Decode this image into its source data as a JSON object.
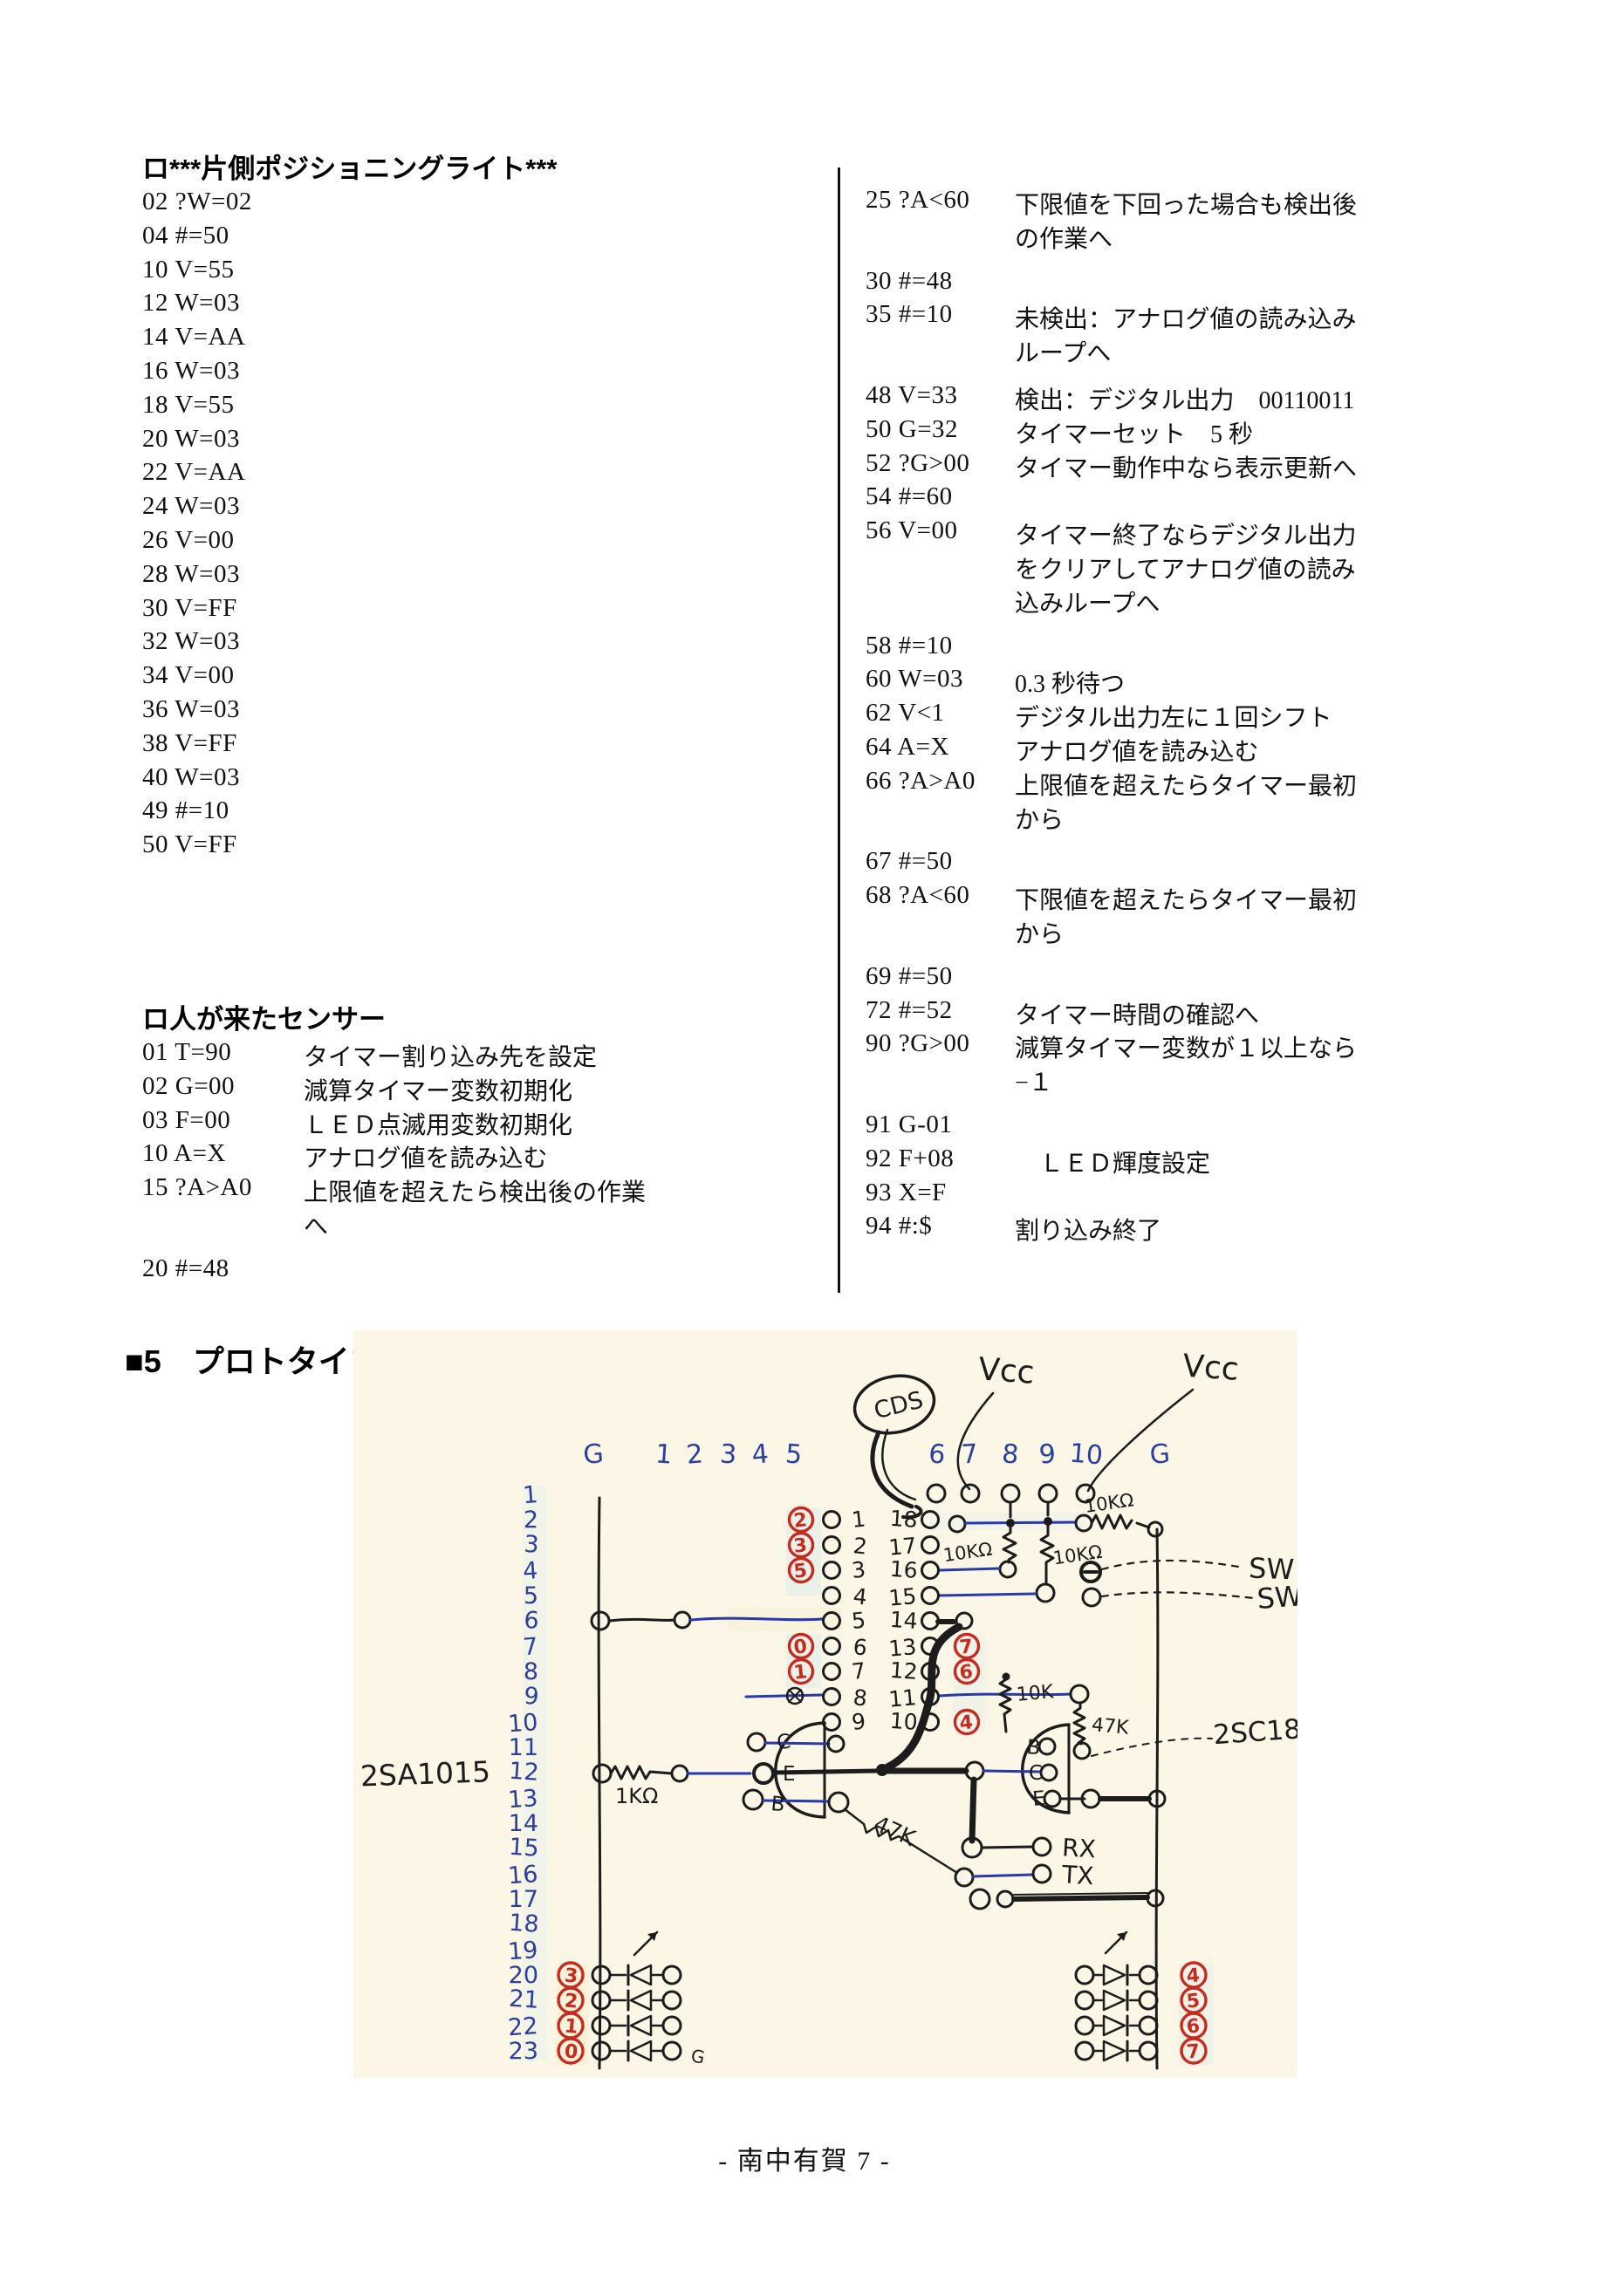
{
  "page": {
    "footer": "- 南中有賀 7 -"
  },
  "columns": {
    "left": {
      "section1": {
        "heading": "ロ***片側ポジショニングライト***",
        "lines": [
          "02 ?W=02",
          "04 #=50",
          "10 V=55",
          "12 W=03",
          "14 V=AA",
          "16 W=03",
          "18 V=55",
          "20 W=03",
          "22 V=AA",
          "24 W=03",
          "26 V=00",
          "28 W=03",
          "30 V=FF",
          "32 W=03",
          "34 V=00",
          "36 W=03",
          "38 V=FF",
          "40 W=03",
          "49 #=10",
          "50 V=FF"
        ]
      },
      "section2": {
        "heading": "ロ人が来たセンサー",
        "lines": [
          {
            "code": "01 T=90",
            "desc": "タイマー割り込み先を設定"
          },
          {
            "code": "02 G=00",
            "desc": "減算タイマー変数初期化"
          },
          {
            "code": "03 F=00",
            "desc": "ＬＥＤ点滅用変数初期化"
          },
          {
            "code": "10 A=X",
            "desc": "アナログ値を読み込む"
          },
          {
            "code": "15 ?A>A0",
            "desc": "上限値を超えたら検出後の作業"
          },
          {
            "code": "",
            "desc": "へ"
          },
          {
            "code": "20 #=48",
            "desc": "",
            "gap": true
          }
        ]
      }
    },
    "right": {
      "lines": [
        {
          "code": "25 ?A<60",
          "desc": "下限値を下回った場合も検出後"
        },
        {
          "code": "",
          "desc": "の作業へ"
        },
        {
          "code": "30 #=48",
          "desc": "",
          "gap": true
        },
        {
          "code": "35 #=10",
          "desc": "未検出：アナログ値の読み込み"
        },
        {
          "code": "",
          "desc": "ループへ"
        },
        {
          "code": "48 V=33",
          "desc": "検出：デジタル出力　00110011",
          "gap": true
        },
        {
          "code": "50 G=32",
          "desc": "タイマーセット　5 秒"
        },
        {
          "code": "52 ?G>00",
          "desc": "タイマー動作中なら表示更新へ"
        },
        {
          "code": "54 #=60",
          "desc": ""
        },
        {
          "code": "56 V=00",
          "desc": "タイマー終了ならデジタル出力"
        },
        {
          "code": "",
          "desc": "をクリアしてアナログ値の読み"
        },
        {
          "code": "",
          "desc": "込みループへ"
        },
        {
          "code": "58 #=10",
          "desc": "",
          "gap": true
        },
        {
          "code": "60 W=03",
          "desc": "0.3 秒待つ"
        },
        {
          "code": "62 V<1",
          "desc": "デジタル出力左に１回シフト"
        },
        {
          "code": "64 A=X",
          "desc": "アナログ値を読み込む"
        },
        {
          "code": "66 ?A>A0",
          "desc": "上限値を超えたらタイマー最初"
        },
        {
          "code": "",
          "desc": "から"
        },
        {
          "code": "67 #=50",
          "desc": "",
          "gap": true
        },
        {
          "code": "68 ?A<60",
          "desc": "下限値を超えたらタイマー最初"
        },
        {
          "code": "",
          "desc": "から"
        },
        {
          "code": "69 #=50",
          "desc": "",
          "gap": true
        },
        {
          "code": "72 #=52",
          "desc": "タイマー時間の確認へ"
        },
        {
          "code": "90 ?G>00",
          "desc": "減算タイマー変数が１以上なら"
        },
        {
          "code": "",
          "desc": "−１"
        },
        {
          "code": "91 G-01",
          "desc": "",
          "gap": true
        },
        {
          "code": "92 F+08",
          "desc": "　ＬＥＤ輝度設定"
        },
        {
          "code": "93 X=F",
          "desc": ""
        },
        {
          "code": "94 #:$",
          "desc": "割り込み終了"
        }
      ]
    }
  },
  "diagram": {
    "heading": "■5　プロトタイプ（ブレッドボード仕様）での配置図",
    "left_header_cols": [
      "G",
      "1",
      "2",
      "3",
      "4",
      "5"
    ],
    "right_header_cols": [
      "6",
      "7",
      "8",
      "9",
      "10",
      "G"
    ],
    "row_numbers": [
      "1",
      "2",
      "3",
      "4",
      "5",
      "6",
      "7",
      "8",
      "9",
      "10",
      "11",
      "12",
      "13",
      "14",
      "15",
      "16",
      "17",
      "18",
      "19",
      "20",
      "21",
      "22",
      "23"
    ],
    "left_pin_numbers": [
      "1",
      "2",
      "3",
      "4",
      "5",
      "6",
      "7",
      "8",
      "9"
    ],
    "right_pin_numbers": [
      "18",
      "17",
      "16",
      "15",
      "14",
      "13",
      "12",
      "11",
      "10"
    ],
    "red_digits": {
      "left_pins": [
        {
          "index": 0,
          "digit": "2"
        },
        {
          "index": 1,
          "digit": "3"
        },
        {
          "index": 2,
          "digit": "5"
        },
        {
          "index": 5,
          "digit": "0"
        },
        {
          "index": 6,
          "digit": "1"
        }
      ],
      "right_pins": [
        {
          "index": 5,
          "digit": "7"
        },
        {
          "index": 6,
          "digit": "6"
        },
        {
          "index": 8,
          "digit": "4"
        }
      ]
    },
    "led_left_digits": [
      "3",
      "2",
      "1",
      "0"
    ],
    "led_right_digits": [
      "4",
      "5",
      "6",
      "7"
    ],
    "transistor_left_pins": [
      "C",
      "E",
      "B"
    ],
    "transistor_right_pins": [
      "B",
      "C",
      "E"
    ],
    "labels": {
      "cds": "CDS",
      "vcc_left": "Vcc",
      "vcc_right": "Vcc",
      "resistor_top": "10KΩ",
      "resistor_pin8": "10KΩ",
      "resistor_pin9": "10KΩ",
      "switch1": "SW",
      "switch2": "SW",
      "resistor_1k": "1KΩ",
      "resistor_10k": "10K",
      "resistor_47k_vertical": "47K",
      "resistor_47k_diagonal": "47K",
      "rx": "RX",
      "tx": "TX",
      "transistor_left": "2SA1015",
      "transistor_right": "2SC181",
      "led_left_tail": "G"
    }
  }
}
